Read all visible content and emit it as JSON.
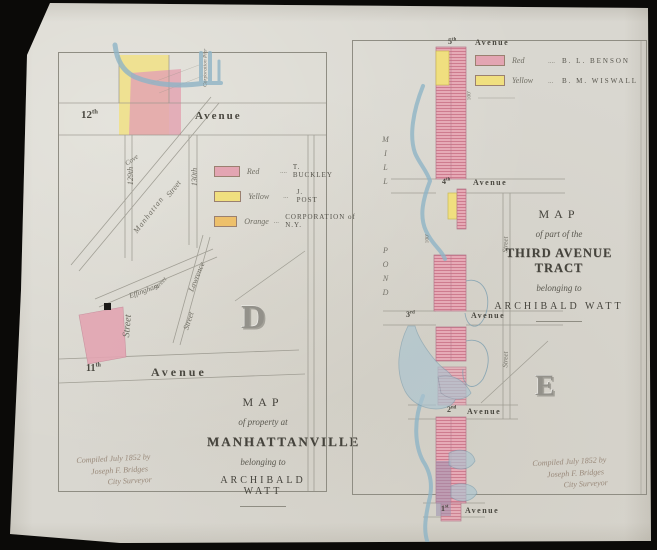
{
  "document": {
    "type": "scanned historical cadastral map, two plates on one sheet",
    "paper_color": "#d9d7d0",
    "backdrop_color": "#0b0a08",
    "ink_color": "#8f8d83",
    "water_color": "#8fb4c6",
    "red_parcel_color": "#e3a5b2",
    "yellow_parcel_color": "#f0df7f",
    "orange_parcel_color": "#edc06b"
  },
  "left_map": {
    "plate_letter": "D",
    "avenue_top": {
      "num": "12",
      "suffix": "th",
      "word": "Avenue"
    },
    "avenue_bottom": {
      "num": "11",
      "suffix": "th",
      "word": "Avenue"
    },
    "streets": {
      "s129": "129th",
      "s130": "130th",
      "cove": "Cove",
      "manhattan": "Manhattan",
      "street": "Street",
      "corporation_pier": "Corporation Pier",
      "effingham": "Effingham",
      "lawrence": "Lawrence"
    },
    "legend": [
      {
        "name": "Red",
        "dots": "....",
        "owner": "T. BUCKLEY",
        "swatch": "#e3a5b2"
      },
      {
        "name": "Yellow",
        "dots": "...",
        "owner": "J. POST",
        "swatch": "#f0df7f"
      },
      {
        "name": "Orange",
        "dots": "...",
        "owner": "CORPORATION of N.Y.",
        "swatch": "#edc06b"
      }
    ],
    "title": [
      "MAP",
      "of property at",
      "MANHATTANVILLE",
      "belonging to",
      "ARCHIBALD WATT"
    ],
    "note": [
      "Compiled July 1852 by",
      "Joseph F. Bridges",
      "City Surveyor"
    ]
  },
  "right_map": {
    "plate_letter": "E",
    "avenue_word": "Avenue",
    "avenues": [
      {
        "num": "5",
        "suffix": "th"
      },
      {
        "num": "4",
        "suffix": "th"
      },
      {
        "num": "3",
        "suffix": "rd"
      },
      {
        "num": "2",
        "suffix": "nd"
      },
      {
        "num": "1",
        "suffix": "st"
      }
    ],
    "water": {
      "mill": "MILL",
      "pond": "POND"
    },
    "street_label": "Street",
    "dim_label": "100'",
    "legend": [
      {
        "name": "Red",
        "dots": "....",
        "owner": "B. L. BENSON",
        "swatch": "#e3a5b2"
      },
      {
        "name": "Yellow",
        "dots": "...",
        "owner": "B. M. WISWALL",
        "swatch": "#f0df7f"
      }
    ],
    "title": [
      "MAP",
      "of part of the",
      "THIRD AVENUE TRACT",
      "belonging to",
      "ARCHIBALD WATT"
    ],
    "note": [
      "Compiled July 1852 by",
      "Joseph F. Bridges",
      "City Surveyor"
    ]
  }
}
